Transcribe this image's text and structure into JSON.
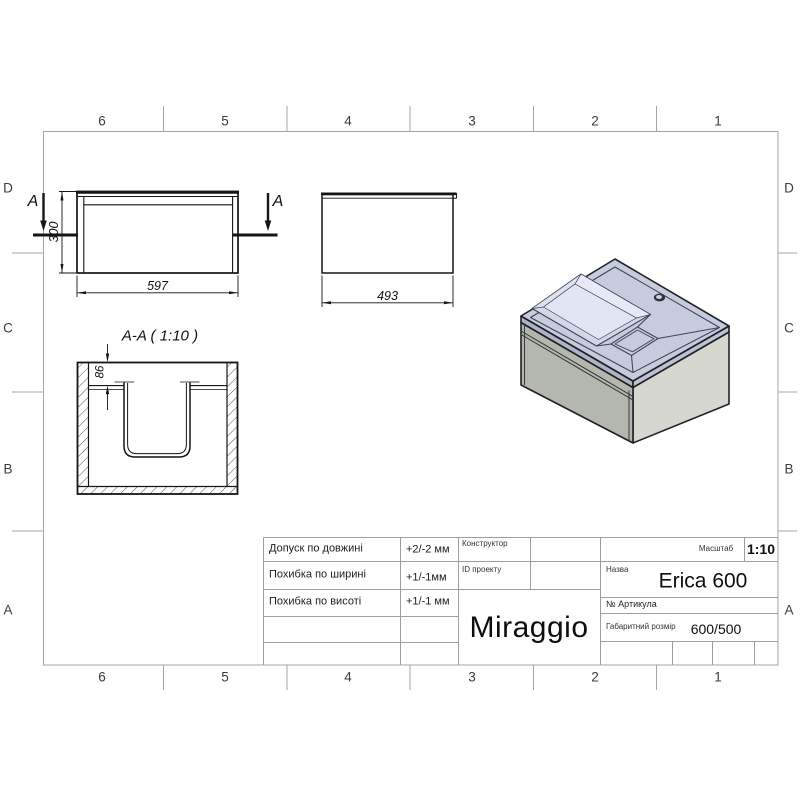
{
  "document": {
    "type": "technical-drawing",
    "product": "Erica 600",
    "brand": "Miraggio"
  },
  "border": {
    "columns": [
      "6",
      "5",
      "4",
      "3",
      "2",
      "1"
    ],
    "rows": [
      "D",
      "C",
      "B",
      "A"
    ]
  },
  "views": {
    "front": {
      "width_dim": "597",
      "height_dim": "300",
      "section_letter": "A"
    },
    "side": {
      "depth_dim": "493"
    },
    "section": {
      "title": "A-A ( 1:10 )",
      "depth_dim": "86"
    }
  },
  "title_block": {
    "tolerances": [
      {
        "label": "Допуск по довжині",
        "value": "+2/-2 мм"
      },
      {
        "label": "Похибка по ширині",
        "value": "+1/-1мм"
      },
      {
        "label": "Похибка по висоті",
        "value": "+1/-1 мм"
      }
    ],
    "constructor_label": "Конструктор",
    "project_id_label": "ID проекту",
    "brand": "Miraggio",
    "scale_label": "Масштаб",
    "scale_value": "1:10",
    "name_label": "Назва",
    "name_value": "Erica 600",
    "article_label": "№  Артикула",
    "size_label": "Габаритний розмір",
    "size_value": "600/500"
  },
  "colors": {
    "line": "#15151a",
    "frame": "#a6a6a6",
    "iso_top_face": "#c6ccdd",
    "iso_basin": "#d2d7e9",
    "iso_cabinet_left": "#b4b7ae",
    "iso_cabinet_right": "#d6d8d0"
  }
}
